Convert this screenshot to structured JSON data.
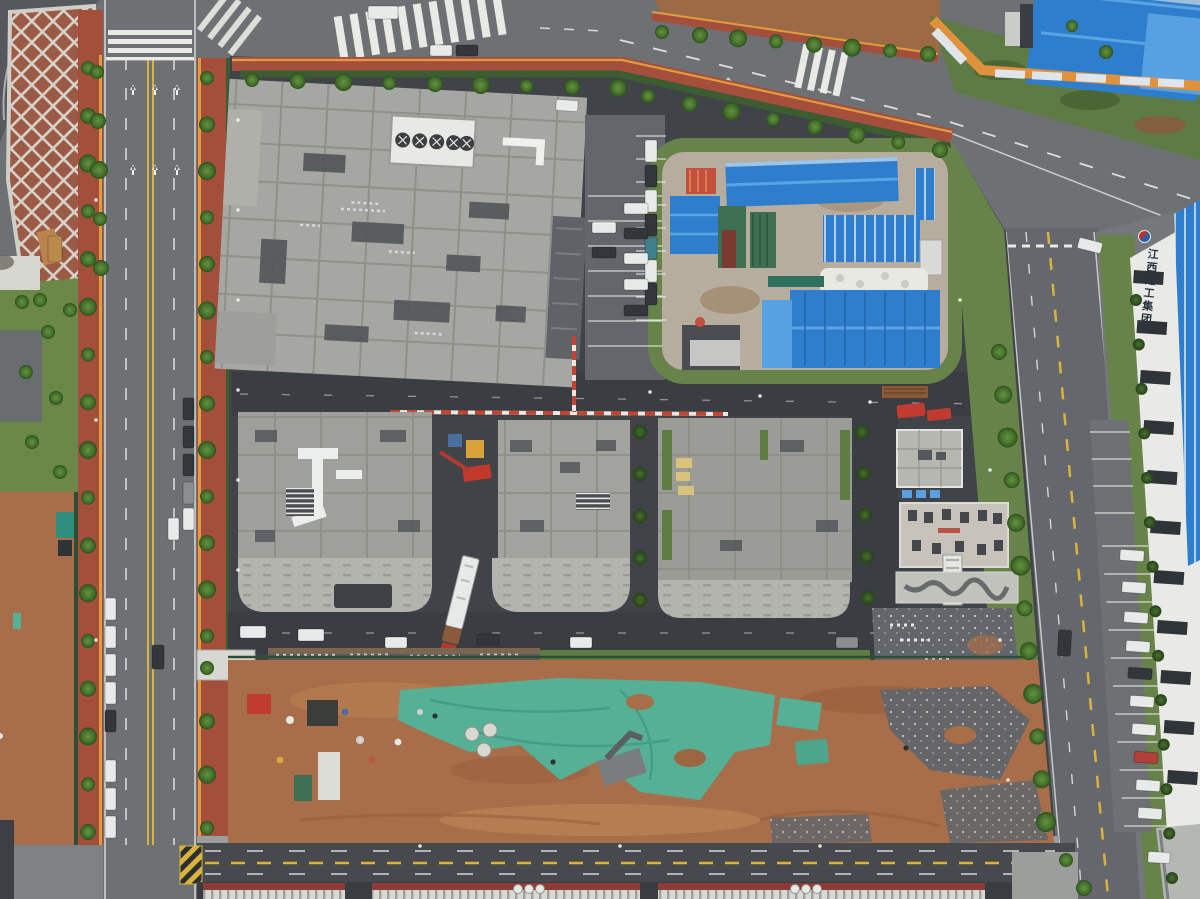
{
  "scene": {
    "type": "aerial-photo",
    "signage": {
      "right_building_vertical_text": "江西建工集团",
      "logo": "red-blue-circle-logo"
    },
    "palette": {
      "road_gray": "#6e7174",
      "road_dark": "#46494d",
      "campus_asphalt": "#404448",
      "sidewalk_red": "#a34f3c",
      "curb_orange": "#e39b3d",
      "grass": "#67834a",
      "hedge": "#3c5c31",
      "dirt": "#a86e49",
      "dirt_light": "#c18a5a",
      "tarp_green": "#55b096",
      "roof_concrete": "#a6a6a2",
      "roof_grid_line": "#8e8e88",
      "roof_dark_panel": "#54575b",
      "blue_roof": "#2e7ecd",
      "blue_roof_light": "#57a0e2",
      "red_roof": "#c2503a",
      "warehouse_red_band": "#8e3a35",
      "warehouse_rib": "#d8d9d5",
      "lane_yellow": "#d9b33c",
      "lane_white": "#f2f2ee"
    },
    "objects": [
      "lattice-slope",
      "left-road",
      "top-road",
      "right-road",
      "bottom-road",
      "factory-building",
      "rooftop-fan-unit",
      "staging-yard",
      "blue-sheds",
      "pipe-stacks",
      "sack-pile",
      "workshop-b",
      "workshop-c",
      "workshop-d",
      "mobile-crane",
      "semi-truck",
      "pipe-rack",
      "east-cluster",
      "red-tents",
      "construction-building",
      "dirt-field",
      "green-tarp",
      "debris-piles",
      "gravel-patches",
      "warehouse-roofs",
      "hq-building",
      "parking-bays",
      "banner-wall"
    ],
    "trees": {
      "rows": [
        {
          "pts": [
            [
              88,
              68
            ],
            [
              88,
              832
            ]
          ],
          "n": 17,
          "r": 8
        },
        {
          "pts": [
            [
              207,
              78
            ],
            [
              207,
              636
            ]
          ],
          "n": 13,
          "r": 8
        },
        {
          "pts": [
            [
              207,
              668
            ],
            [
              207,
              828
            ]
          ],
          "n": 4,
          "r": 8
        },
        {
          "pts": [
            [
              252,
              80
            ],
            [
              618,
              88
            ]
          ],
          "n": 9,
          "r": 8
        },
        {
          "pts": [
            [
              648,
              96
            ],
            [
              940,
              150
            ]
          ],
          "n": 8,
          "r": 8
        },
        {
          "pts": [
            [
              662,
              32
            ],
            [
              928,
              54
            ]
          ],
          "n": 8,
          "r": 8
        },
        {
          "pts": [
            [
              999,
              352
            ],
            [
              1046,
              822
            ]
          ],
          "n": 12,
          "r": 9
        },
        {
          "pts": [
            [
              97,
              72
            ],
            [
              101,
              268
            ]
          ],
          "n": 5,
          "r": 8
        },
        {
          "pts": [
            [
              1066,
              860
            ],
            [
              1084,
              888
            ]
          ],
          "n": 2,
          "r": 8
        },
        {
          "pts": [
            [
              1072,
              26
            ],
            [
              1106,
              52
            ]
          ],
          "n": 2,
          "r": 7
        }
      ],
      "shrub_rows": [
        {
          "pts": [
            [
              1136,
              300
            ],
            [
              1172,
              878
            ]
          ],
          "n": 14,
          "r": 6
        },
        {
          "pts": [
            [
              640,
              432
            ],
            [
              640,
              600
            ]
          ],
          "n": 5,
          "r": 7
        },
        {
          "pts": [
            [
              862,
              432
            ],
            [
              868,
              598
            ]
          ],
          "n": 5,
          "r": 7
        }
      ],
      "bushes": [
        [
          22,
          302
        ],
        [
          48,
          332
        ],
        [
          26,
          372
        ],
        [
          56,
          398
        ],
        [
          32,
          442
        ],
        [
          60,
          472
        ],
        [
          70,
          310
        ],
        [
          40,
          300
        ]
      ]
    },
    "cars": [
      [
        105,
        598,
        11,
        22,
        0,
        "w"
      ],
      [
        105,
        626,
        11,
        22,
        0,
        "w"
      ],
      [
        105,
        654,
        11,
        22,
        0,
        "w"
      ],
      [
        105,
        682,
        11,
        22,
        0,
        "w"
      ],
      [
        105,
        710,
        11,
        22,
        0,
        "d"
      ],
      [
        105,
        760,
        11,
        22,
        0,
        "w"
      ],
      [
        105,
        788,
        11,
        22,
        0,
        "w"
      ],
      [
        105,
        816,
        11,
        22,
        0,
        "w"
      ],
      [
        183,
        398,
        11,
        22,
        0,
        "d"
      ],
      [
        183,
        426,
        11,
        22,
        0,
        "d"
      ],
      [
        183,
        454,
        11,
        22,
        0,
        "d"
      ],
      [
        183,
        482,
        11,
        22,
        0,
        "g"
      ],
      [
        183,
        508,
        11,
        22,
        0,
        "w"
      ],
      [
        152,
        645,
        12,
        24,
        0,
        "d"
      ],
      [
        168,
        518,
        11,
        22,
        0,
        "w"
      ],
      [
        368,
        6,
        30,
        13,
        0,
        "w"
      ],
      [
        430,
        45,
        22,
        11,
        0,
        "w"
      ],
      [
        456,
        45,
        22,
        11,
        0,
        "d"
      ],
      [
        1078,
        240,
        24,
        11,
        14,
        "w"
      ],
      [
        645,
        140,
        12,
        22,
        0,
        "w"
      ],
      [
        645,
        165,
        12,
        22,
        0,
        "d"
      ],
      [
        645,
        190,
        12,
        22,
        0,
        "w"
      ],
      [
        645,
        214,
        12,
        22,
        0,
        "d"
      ],
      [
        645,
        237,
        12,
        22,
        0,
        "t"
      ],
      [
        645,
        260,
        12,
        22,
        0,
        "w"
      ],
      [
        645,
        283,
        12,
        22,
        0,
        "d"
      ],
      [
        592,
        222,
        24,
        11,
        0,
        "w"
      ],
      [
        592,
        247,
        24,
        11,
        0,
        "d"
      ],
      [
        624,
        203,
        24,
        11,
        0,
        "w"
      ],
      [
        624,
        228,
        24,
        11,
        0,
        "d"
      ],
      [
        624,
        253,
        24,
        11,
        0,
        "w"
      ],
      [
        624,
        279,
        24,
        11,
        0,
        "w"
      ],
      [
        624,
        305,
        24,
        11,
        0,
        "d"
      ],
      [
        556,
        100,
        22,
        11,
        4,
        "w"
      ],
      [
        240,
        626,
        26,
        12,
        0,
        "w"
      ],
      [
        298,
        629,
        26,
        12,
        0,
        "w"
      ],
      [
        385,
        637,
        22,
        11,
        0,
        "w"
      ],
      [
        477,
        634,
        22,
        11,
        0,
        "d"
      ],
      [
        570,
        637,
        22,
        11,
        0,
        "w"
      ],
      [
        836,
        637,
        22,
        11,
        0,
        "g"
      ],
      [
        1120,
        550,
        24,
        11,
        4,
        "w"
      ],
      [
        1122,
        582,
        24,
        11,
        4,
        "w"
      ],
      [
        1124,
        612,
        24,
        11,
        4,
        "w"
      ],
      [
        1126,
        641,
        24,
        11,
        4,
        "w"
      ],
      [
        1128,
        668,
        24,
        11,
        4,
        "d"
      ],
      [
        1130,
        696,
        24,
        11,
        4,
        "w"
      ],
      [
        1132,
        724,
        24,
        11,
        4,
        "w"
      ],
      [
        1134,
        752,
        24,
        11,
        4,
        "r"
      ],
      [
        1136,
        780,
        24,
        11,
        4,
        "w"
      ],
      [
        1138,
        808,
        24,
        11,
        4,
        "w"
      ],
      [
        1058,
        630,
        13,
        26,
        3,
        "d"
      ],
      [
        1148,
        852,
        22,
        11,
        3,
        "w"
      ],
      [
        48,
        236,
        14,
        26,
        0,
        "y"
      ]
    ],
    "car_colors": {
      "w": "#e8eae9",
      "d": "#33373b",
      "r": "#b04038",
      "t": "#3f808a",
      "g": "#8b8e91",
      "y": "#b98a4a"
    },
    "parking_bays": [
      {
        "x": 1102,
        "y": 546,
        "dx": 2.2,
        "dy": 28,
        "len": 46,
        "n": 11
      },
      {
        "x": 588,
        "y": 196,
        "dx": 0,
        "dy": 25,
        "len": 74,
        "n": 7
      },
      {
        "x": 636,
        "y": 136,
        "dx": 0,
        "dy": 23,
        "len": 30,
        "n": 9
      },
      {
        "x": 1090,
        "y": 432,
        "dx": 1.5,
        "dy": 27,
        "len": 40,
        "n": 4
      }
    ],
    "window_rows": [
      {
        "x": 1134,
        "y": 270,
        "dx": 3.4,
        "dy": 50,
        "w": 30,
        "h": 13,
        "n": 11
      }
    ],
    "counts": {
      "rooftop_fans": 5,
      "warehouse_vent_pipes": 6,
      "banner_panels": 8,
      "concrete_rings": 3
    }
  }
}
